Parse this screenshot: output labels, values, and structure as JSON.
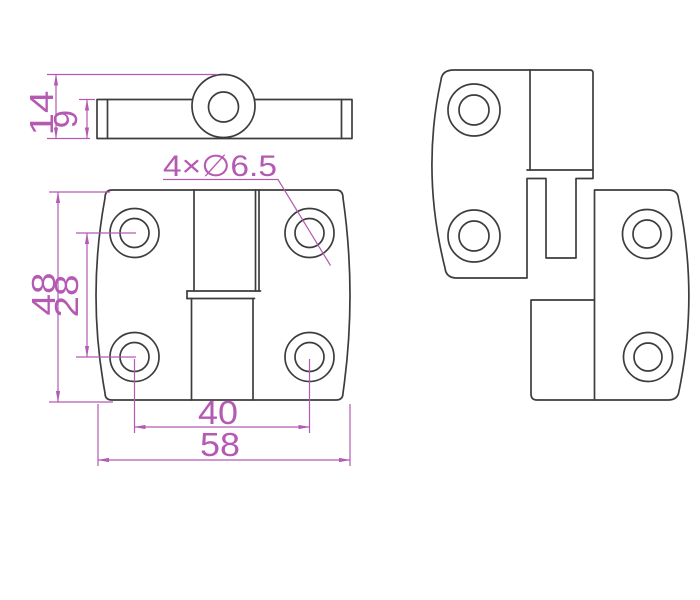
{
  "drawing": {
    "kind": "hinge-technical-drawing",
    "background": "#ffffff",
    "colors": {
      "part_outline": "#3d3d3d",
      "dimension": "#b55ab2"
    },
    "views": {
      "side_view": "top-left side profile with center knuckle",
      "front_view": "bottom-left front face with 4 mounting holes",
      "exploded_view": "right side, two hinge leaves separated showing pin"
    }
  },
  "dimensions": {
    "side_overall_height": "14",
    "side_leaf_thickness": "9",
    "hole_callout": "4×∅6.5",
    "front_height": "48",
    "front_hole_spacing_vertical": "28",
    "front_hole_spacing_horizontal": "40",
    "front_width": "58"
  }
}
